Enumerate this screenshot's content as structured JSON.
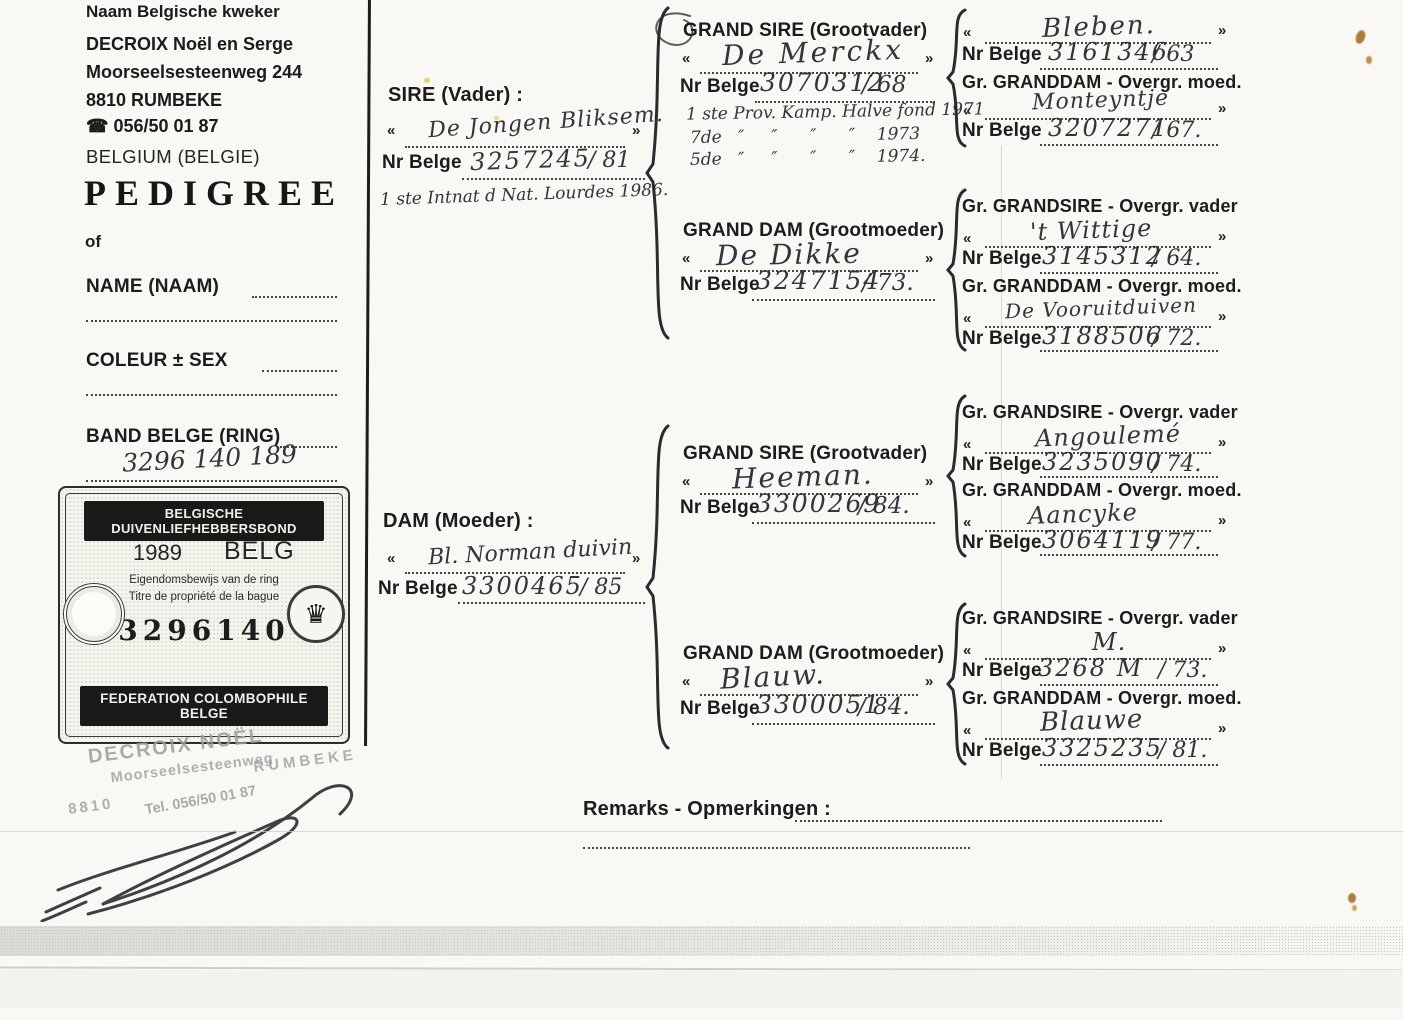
{
  "colors": {
    "ink": "#33343c",
    "paper": "#f9f8f4",
    "stamp_grey": "#9d9d9d",
    "banner_black": "#191919"
  },
  "symbols": {
    "guillemet_open": "«",
    "guillemet_close": "»",
    "phone_icon": "☎",
    "crown_icon": "♛"
  },
  "labels": {
    "nr_belge": "Nr Belge",
    "gr_grandsire": "Gr. GRANDSIRE - Overgr. vader",
    "gr_granddam": "Gr. GRANDDAM - Overgr. moed.",
    "remarks": "Remarks - Opmerkingen :"
  },
  "breeder": {
    "field_label": "Naam Belgische kweker",
    "name": "DECROIX Noël en Serge",
    "street": "Moorseelsesteenweg 244",
    "city": "8810 RUMBEKE",
    "phone": "056/50 01 87",
    "country": "BELGIUM (BELGIE)"
  },
  "title": "PEDIGREE",
  "title_of": "of",
  "bird": {
    "name_label": "NAME (NAAM)",
    "colour_label": "COLEUR ± SEX",
    "band_label": "BAND BELGE (RING)",
    "band_value": "3296 140 189"
  },
  "ring_certificate": {
    "federation_nl": "BELGISCHE DUIVENLIEFHEBBERSBOND",
    "year": "1989",
    "country": "BELG",
    "ownership_nl": "Eigendomsbewijs van de ring",
    "ownership_fr": "Titre de propriété de la bague",
    "ring_number": "3296140",
    "federation_fr": "FEDERATION COLOMBOPHILE BELGE"
  },
  "address_stamp": {
    "name": "DECROIX NOËL",
    "street": "Moorseelsesteenweg",
    "postal": "8810",
    "city": "RUMBEKE",
    "tel": "Tel. 056/50 01 87"
  },
  "sire": {
    "label": "SIRE (Vader) :",
    "name": "De Jongen Bliksem.",
    "ring": "3257245",
    "year": "/ 81",
    "note": "1 ste Intnat d Nat. Lourdes 1986."
  },
  "dam": {
    "label": "DAM (Moeder) :",
    "name": "Bl. Norman duivin",
    "ring": "3300465",
    "year": "/ 85"
  },
  "grandparents": [
    {
      "label": "GRAND SIRE (Grootvader)",
      "name": "De Merckx",
      "ring": "3070312",
      "year": "/ 68",
      "note1": "1 ste Prov. Kamp. Halve fond 1971",
      "note2": "7de   ″     ″      ″      ″    1973",
      "note3": "5de   ″     ″      ″      ″    1974."
    },
    {
      "label": "GRAND DAM (Grootmoeder)",
      "name": "De Dikke",
      "ring": "3247154",
      "year": "/ 73."
    },
    {
      "label": "GRAND SIRE (Grootvader)",
      "name": "Heeman.",
      "ring": "3300269",
      "year": "/ 84."
    },
    {
      "label": "GRAND DAM (Grootmoeder)",
      "name": "Blauw.",
      "ring": "3300051",
      "year": "/ 84."
    }
  ],
  "great_grandparents": [
    {
      "sire_name": "Bleben.",
      "sire_ring": "3161346",
      "sire_year": "/ 63",
      "dam_name": "Monteyntje",
      "dam_ring": "3207271",
      "dam_year": "/ 67."
    },
    {
      "sire_name": "'t Wittige",
      "sire_ring": "3145312",
      "sire_year": "/ 64.",
      "dam_name": "De Vooruitduiven",
      "dam_ring": "3188506",
      "dam_year": "/ 72."
    },
    {
      "sire_name": "Angoulemé",
      "sire_ring": "3235090",
      "sire_year": "/ 74.",
      "dam_name": "Aancyke",
      "dam_ring": "3064119",
      "dam_year": "/ 77."
    },
    {
      "sire_name": "M.",
      "sire_ring": "3268 M",
      "sire_year": "/ 73.",
      "dam_name": "Blauwe",
      "dam_ring": "3325235",
      "dam_year": "/ 81."
    }
  ]
}
